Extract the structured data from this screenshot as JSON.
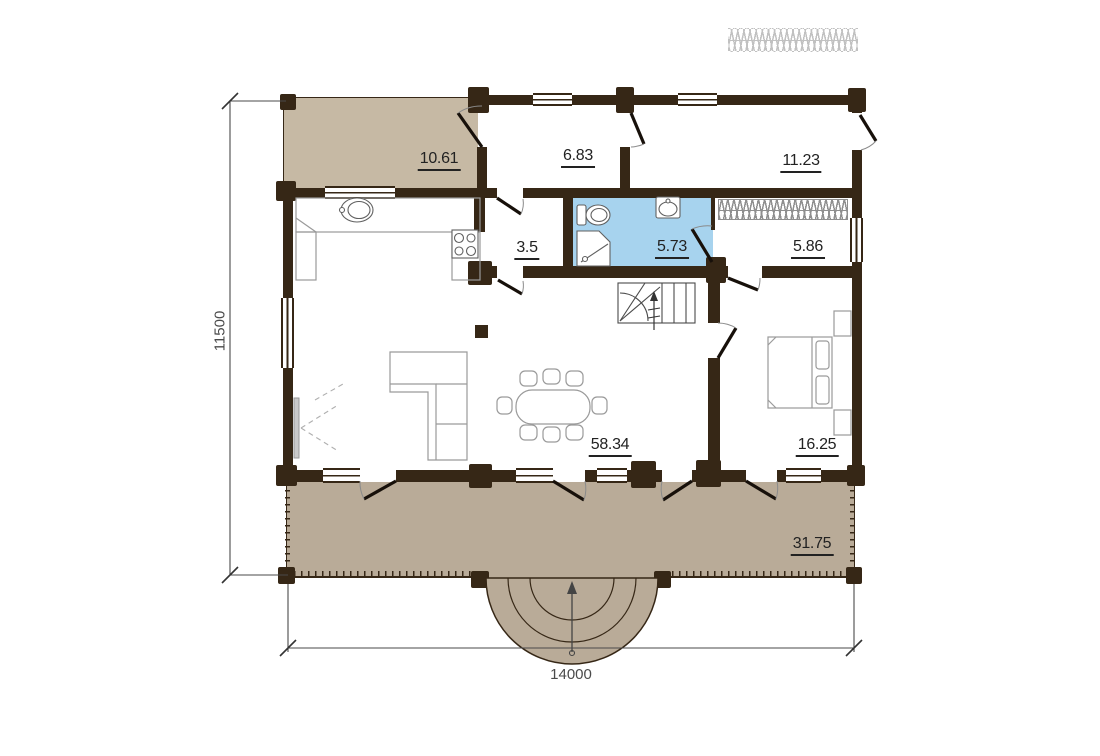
{
  "rooms": [
    {
      "id": "terrace-top",
      "area": "10.61"
    },
    {
      "id": "entry-hall",
      "area": "6.83"
    },
    {
      "id": "room-top-right",
      "area": "11.23"
    },
    {
      "id": "corridor",
      "area": "3.5"
    },
    {
      "id": "bathroom",
      "area": "5.73"
    },
    {
      "id": "dressing-room",
      "area": "5.86"
    },
    {
      "id": "living-room",
      "area": "58.34"
    },
    {
      "id": "bedroom",
      "area": "16.25"
    },
    {
      "id": "terrace-bottom",
      "area": "31.75"
    }
  ],
  "dimensions": {
    "horizontal": "14000",
    "vertical": "11500"
  },
  "colors": {
    "wall": "#362716",
    "terrace": "#b9ab98",
    "terrace_top": "#c6b9a4",
    "bath": "#a7d3ee",
    "line": "#9a9a9a",
    "leaf": "#17100a",
    "hatch": "#8f8f8f",
    "text": "#222222",
    "dim": "#4a4a4a"
  }
}
